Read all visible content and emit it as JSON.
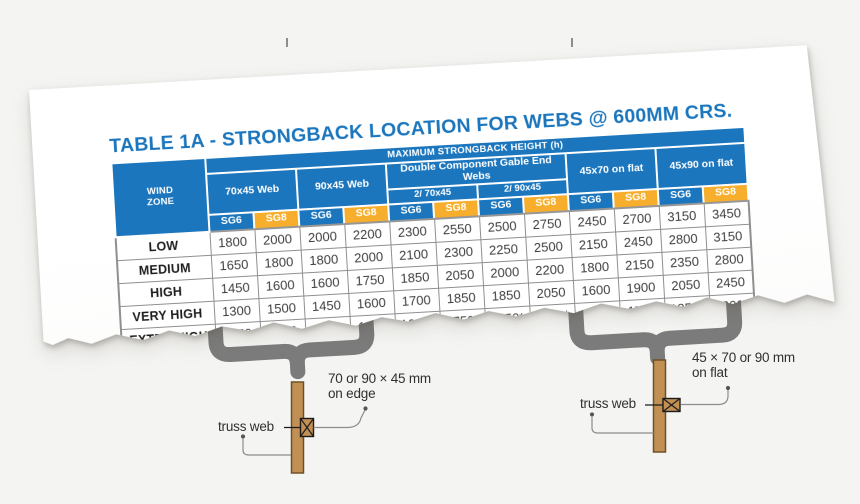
{
  "colors": {
    "header_blue": "#1B76BD",
    "header_yellow": "#F6AE2C",
    "title_blue": "#1B76BD",
    "wood_tan": "#C28F55",
    "brace_gray": "#7B7B7B"
  },
  "title": "TABLE 1A - STRONGBACK LOCATION FOR WEBS @ 600MM CRS.",
  "table": {
    "wind_header": "WIND\nZONE",
    "span_header": "MAXIMUM STRONGBACK HEIGHT (h)",
    "groups": [
      "70x45 Web",
      "90x45 Web",
      "Double Component Gable End Webs",
      "45x70 on flat",
      "45x90 on flat"
    ],
    "subgroups": [
      "2/ 70x45",
      "2/ 90x45"
    ],
    "grade_row": [
      "SG6",
      "SG8",
      "SG6",
      "SG8",
      "SG6",
      "SG8",
      "SG6",
      "SG8",
      "SG6",
      "SG8",
      "SG6",
      "SG8"
    ],
    "rows": [
      {
        "zone": "LOW",
        "values": [
          "1800",
          "2000",
          "2000",
          "2200",
          "2300",
          "2550",
          "2500",
          "2750",
          "2450",
          "2700",
          "3150",
          "3450"
        ]
      },
      {
        "zone": "MEDIUM",
        "values": [
          "1650",
          "1800",
          "1800",
          "2000",
          "2100",
          "2300",
          "2250",
          "2500",
          "2150",
          "2450",
          "2800",
          "3150"
        ]
      },
      {
        "zone": "HIGH",
        "values": [
          "1450",
          "1600",
          "1600",
          "1750",
          "1850",
          "2050",
          "2000",
          "2200",
          "1800",
          "2150",
          "2350",
          "2800"
        ]
      },
      {
        "zone": "VERY HIGH",
        "values": [
          "1300",
          "1500",
          "1450",
          "1600",
          "1700",
          "1850",
          "1850",
          "2050",
          "1600",
          "1900",
          "2050",
          "2450"
        ]
      },
      {
        "zone": "EXTRA HIGH",
        "values": [
          "1150",
          "1350",
          "1300",
          "1500",
          "1600*",
          "1750*",
          "1750*",
          "1900*",
          "1450",
          "1700",
          "1850*",
          "2200*"
        ]
      }
    ]
  },
  "diagrams": {
    "left": {
      "size_label": "70 or 90 × 45 mm\non edge",
      "web_label": "truss web"
    },
    "right": {
      "size_label": "45 × 70 or 90 mm\non flat",
      "web_label": "truss web"
    }
  }
}
